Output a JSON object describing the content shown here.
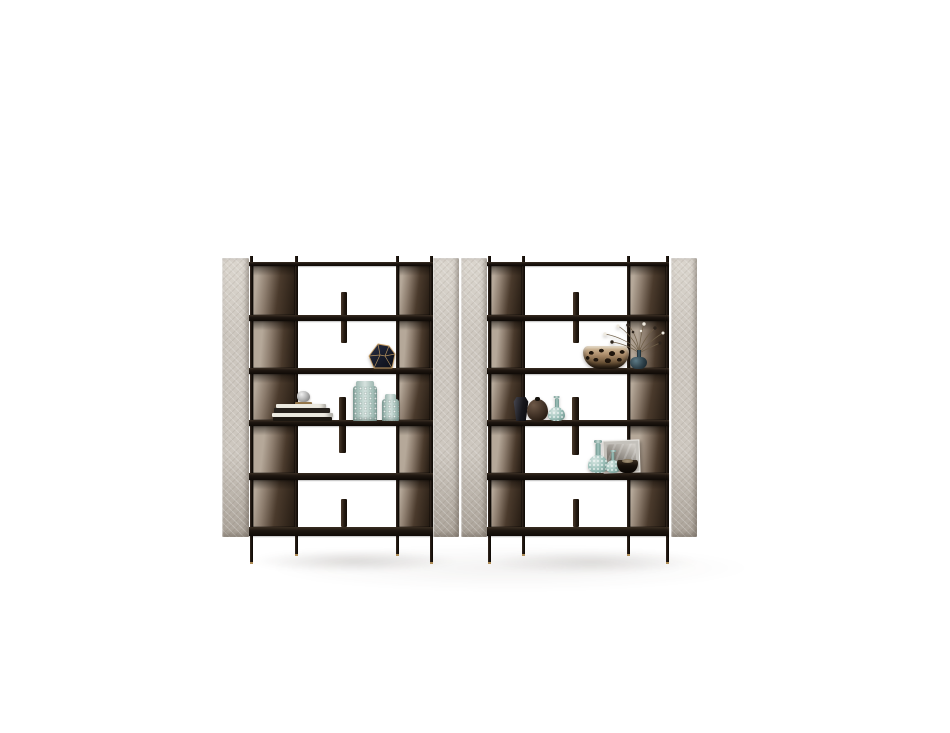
{
  "scene": {
    "type": "furniture-product-photo",
    "description": "Two freestanding modular bookshelf units with dark bronze metal frames, beige quilted upholstered side panels and smoked-bronze back panels, styled with decorative vases, books, bowls and a framed print, on a plain white studio background with a soft floor shadow",
    "canvas_width": 950,
    "canvas_height": 733,
    "background_color": "#ffffff"
  },
  "palette": {
    "bg": "#ffffff",
    "panel_beige": "#cdc7bf",
    "panel_beige_hi": "#dbd6ce",
    "panel_beige_deep": "#aaa298",
    "frame_black": "#1a140f",
    "bronze_l1": "#b5a899",
    "bronze_l2": "#8d7d6e",
    "bronze_d1": "#4a3a2c",
    "bronze_d2": "#261c13",
    "brass": "#b08e58",
    "teal_body": "#b7cdc7",
    "teal_deep": "#8aa9a2",
    "glass_teal": "#9fc2bb",
    "glass_teal_deep": "#6f958e",
    "navy": "#1c2133",
    "gold": "#c49c63",
    "leo_tan": "#b29270",
    "leo_dark": "#1f150c",
    "glass_dark": "#2e4049",
    "stem": "#6f5f49",
    "blossom": "#efeae0",
    "bud": "#2f261e",
    "book_light": "#edeae1",
    "book_dark": "#26211c",
    "silver_hi": "#f0f0f0",
    "silver_lo": "#6d6d6d",
    "pic_frame": "#dad7d2",
    "photo_b": "#9b968f",
    "bowl_black": "#17100a",
    "vase_black": "#17171c",
    "vase_brown": "#46362a"
  },
  "shelving": {
    "shelf_ys": [
      262,
      315,
      368,
      420,
      473,
      527
    ],
    "shelf_heights": [
      4,
      6,
      6,
      6,
      7,
      9
    ],
    "nub_top": 256,
    "panel_top": 258,
    "panel_bottom": 537,
    "outer_leg_bottom": 564,
    "inner_leg_bottom": 556,
    "post_width": 3,
    "bronze_light_pos": [
      12,
      22,
      10,
      26,
      8
    ],
    "bronze_angle": [
      97,
      94,
      100,
      96,
      98
    ],
    "units": [
      {
        "name": "left-shelf-unit",
        "panels": [
          [
            222,
            27
          ],
          [
            433,
            26
          ]
        ],
        "posts": [
          250,
          295,
          396,
          430
        ],
        "shelf_span": [
          249,
          433
        ],
        "bronze_columns": [
          [
            253,
            42
          ],
          [
            399,
            31
          ]
        ],
        "fins": [
          [
            341,
            292,
            6,
            343
          ],
          [
            339,
            397,
            7,
            453
          ],
          [
            341,
            499,
            6,
            527
          ]
        ]
      },
      {
        "name": "right-shelf-unit",
        "panels": [
          [
            461,
            26
          ],
          [
            671,
            26
          ]
        ],
        "posts": [
          488,
          522,
          627,
          666
        ],
        "shelf_span": [
          487,
          669
        ],
        "bronze_columns": [
          [
            491,
            31
          ],
          [
            630,
            36
          ]
        ],
        "fins": [
          [
            573,
            292,
            6,
            343
          ],
          [
            572,
            397,
            7,
            455
          ],
          [
            573,
            499,
            6,
            527
          ]
        ]
      }
    ]
  },
  "decor": {
    "faceted_vase": {
      "label": "dark faceted geometric vase with gold edges",
      "box": [
        368,
        343,
        28,
        26
      ]
    },
    "silver_trinket": {
      "label": "small silver sculpture on gold tray",
      "box": [
        289,
        391,
        30,
        15
      ]
    },
    "book_stack": {
      "label": "stack of coffee-table books",
      "box": [
        272,
        404,
        61,
        17
      ]
    },
    "teal_vase_tall": {
      "label": "tall textured celadon vase",
      "box": [
        353,
        381,
        24,
        40
      ]
    },
    "teal_vase_short": {
      "label": "short textured celadon vase",
      "box": [
        382,
        394,
        17,
        27
      ]
    },
    "leopard_bowl": {
      "label": "leopard-print round bowl",
      "box": [
        583,
        346,
        46,
        23
      ]
    },
    "flower_vase": {
      "label": "dark glass bottle vase",
      "box": [
        630,
        350,
        17,
        19
      ]
    },
    "flower_sprigs": {
      "label": "dried flower sprigs",
      "box": [
        597,
        322,
        71,
        31
      ]
    },
    "black_vase": {
      "label": "black angular vase",
      "box": [
        513,
        397,
        16,
        24
      ]
    },
    "brown_vase": {
      "label": "round brown vase",
      "box": [
        527,
        399,
        21,
        22
      ]
    },
    "teal_genie_small": {
      "label": "small teal glass bottle vase",
      "box": [
        548,
        396,
        17,
        25
      ]
    },
    "teal_genie_tall": {
      "label": "tall teal glass bottle vase",
      "box": [
        588,
        440,
        20,
        33
      ]
    },
    "teal_genie_mid": {
      "label": "medium teal glass bottle vase",
      "box": [
        606,
        450,
        14,
        23
      ]
    },
    "framed_picture": {
      "label": "framed grayscale art print",
      "box": [
        603,
        440,
        37,
        33
      ]
    },
    "black_bowl": {
      "label": "small dark bowl",
      "box": [
        617,
        460,
        21,
        13
      ]
    }
  }
}
